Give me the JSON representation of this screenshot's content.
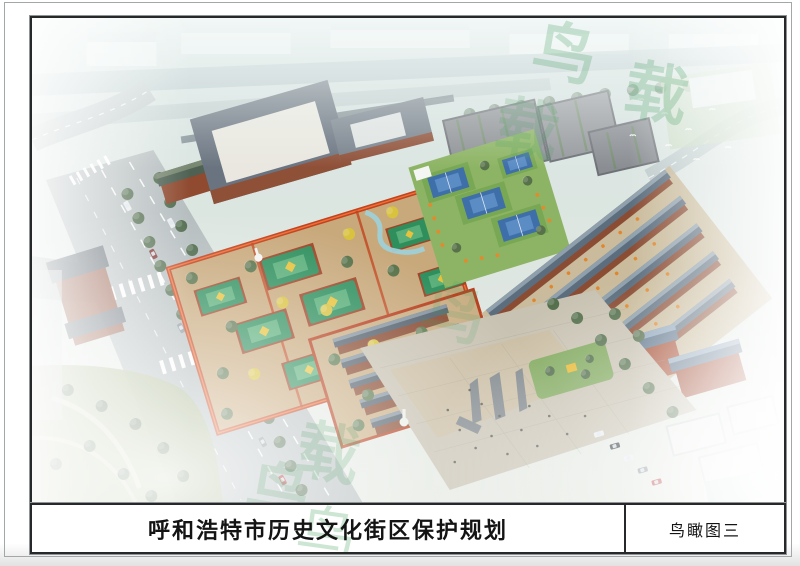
{
  "sheet": {
    "kind": "urban-planning presentation board",
    "title_block": {
      "title": "呼和浩特市历史文化街区保护规划",
      "caption": "鸟瞰图三"
    },
    "artwork": {
      "type": "aerial bird's-eye 3D rendering",
      "watermark": {
        "glyphs": [
          "鸟",
          "载"
        ],
        "color_hint": "#46a05f"
      }
    },
    "palette": {
      "page_bg": "#ffffff",
      "frame_border": "#26282a",
      "haze": "#dfe7e4",
      "road_grey": "#b5bdbe",
      "temple_roof_green": "#2e8f5d",
      "temple_roof_highlight": "#7cc98f",
      "gold_roof": "#f0b42c",
      "red_wall": "#c2431d",
      "brick_red": "#9a5036",
      "grey_roof": "#55616d",
      "court_blue": "#3f6fa8",
      "lawn_green": "#8db464",
      "tree_green": "#4f6b4a",
      "paving_tan": "#c8b894",
      "plaza_grey": "#c8c2b2",
      "stream_blue": "#9fd0d8",
      "pool_green": "#a8d4bc"
    }
  }
}
